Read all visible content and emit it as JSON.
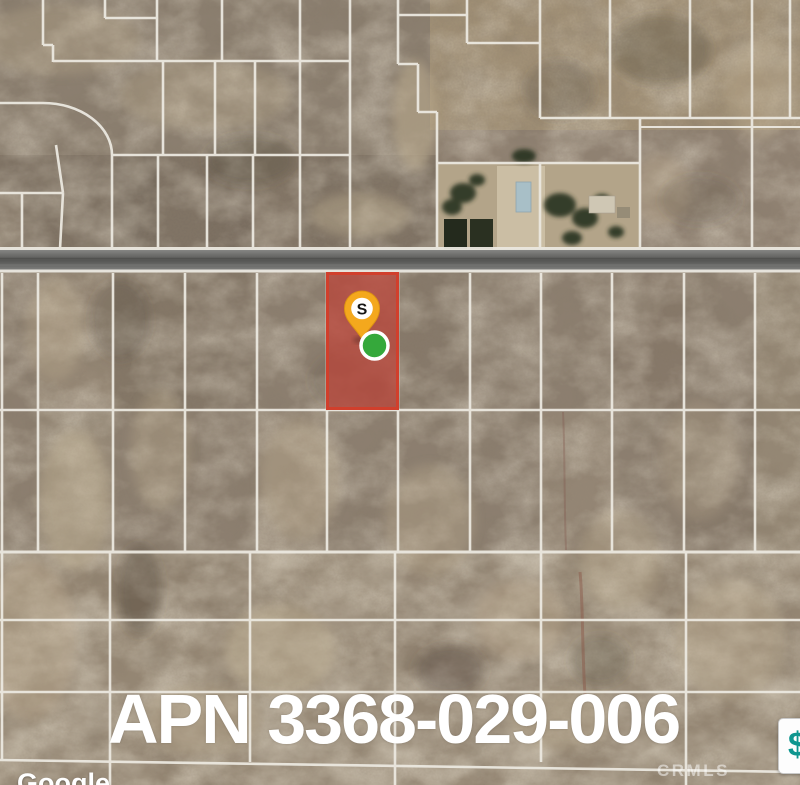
{
  "map": {
    "apn_label": "APN 3368-029-006",
    "pin_label": "S",
    "watermark_google": "Google",
    "watermark_crmls": "CRMLS",
    "price_marker_label": "$",
    "colors": {
      "terrain_base": "#8f8172",
      "parcel_line": "#ebe8e0",
      "road": "#636361",
      "highlighted_parcel_fill": "#b8473b",
      "highlighted_parcel_border": "#d13f2c",
      "pin_orange": "#f4a81d",
      "status_dot_green": "#35a83b",
      "price_marker_teal": "#0e968f"
    }
  }
}
